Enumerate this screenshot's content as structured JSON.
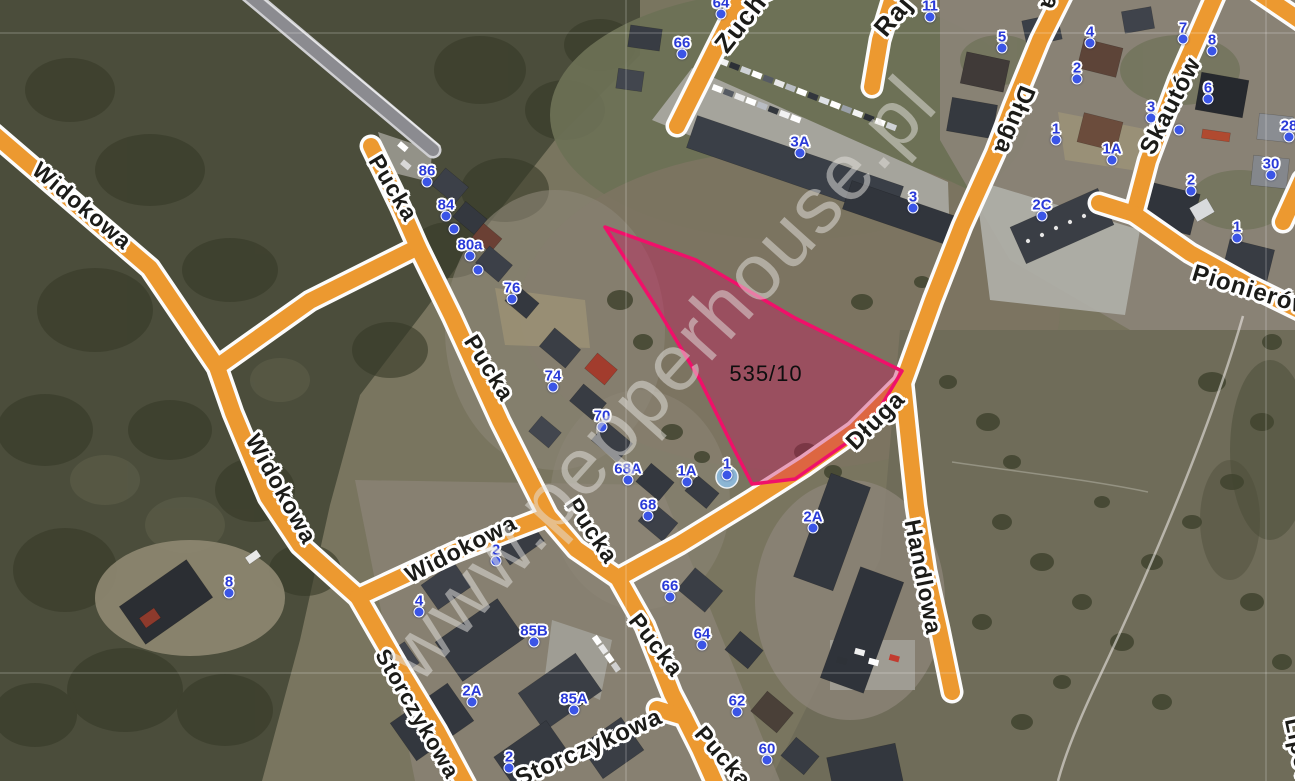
{
  "app": {
    "view": "satellite-map-with-cadastral-overlay"
  },
  "parcel": {
    "label": "535/10",
    "outline_color": "#f0106a",
    "fill_color": "rgba(201,24,93,0.40)"
  },
  "watermark": {
    "text": "www.pepperhouse.pl"
  },
  "colors": {
    "road_fill": "#ec9930",
    "road_casing": "#fcfcfc",
    "highway_gray": "#8b8b90",
    "marker_blue": "#2a3ad8",
    "street_text": "#1b1b18"
  },
  "streets": [
    {
      "label": "Widokowa",
      "x": 82,
      "y": 206,
      "rot": 40,
      "size": 23
    },
    {
      "label": "Widokowa",
      "x": 281,
      "y": 489,
      "rot": 61,
      "size": 23
    },
    {
      "label": "Widokowa",
      "x": 461,
      "y": 549,
      "rot": -27,
      "size": 23
    },
    {
      "label": "Storczykowa",
      "x": 417,
      "y": 714,
      "rot": 60,
      "size": 22
    },
    {
      "label": "Storczykowa",
      "x": 589,
      "y": 748,
      "rot": -24,
      "size": 24
    },
    {
      "label": "Pucka",
      "x": 393,
      "y": 188,
      "rot": 59,
      "size": 23
    },
    {
      "label": "Pucka",
      "x": 489,
      "y": 368,
      "rot": 58,
      "size": 23
    },
    {
      "label": "Pucka",
      "x": 592,
      "y": 531,
      "rot": 56,
      "size": 23
    },
    {
      "label": "Pucka",
      "x": 656,
      "y": 645,
      "rot": 52,
      "size": 23
    },
    {
      "label": "Pucka",
      "x": 723,
      "y": 757,
      "rot": 49,
      "size": 23
    },
    {
      "label": "Długa",
      "x": 1014,
      "y": 120,
      "rot": 112,
      "size": 24
    },
    {
      "label": "Długa",
      "x": 1060,
      "y": -24,
      "rot": 112,
      "size": 24
    },
    {
      "label": "Długa",
      "x": 876,
      "y": 421,
      "rot": -45,
      "size": 24
    },
    {
      "label": "Handlowa",
      "x": 923,
      "y": 577,
      "rot": 79,
      "size": 23
    },
    {
      "label": "Skautów",
      "x": 1171,
      "y": 106,
      "rot": -63,
      "size": 24
    },
    {
      "label": "Pionierów",
      "x": 1252,
      "y": 291,
      "rot": 17,
      "size": 24
    },
    {
      "label": "Zuchów",
      "x": 752,
      "y": 8,
      "rot": -52,
      "size": 26
    },
    {
      "label": "Raj",
      "x": 893,
      "y": 16,
      "rot": -50,
      "size": 26
    },
    {
      "label": "Lipowa",
      "x": 1301,
      "y": 760,
      "rot": 78,
      "size": 23
    }
  ],
  "markers": [
    {
      "label": "86",
      "x": 427,
      "y": 171
    },
    {
      "label": "84",
      "x": 446,
      "y": 205
    },
    {
      "label": "80a",
      "x": 470,
      "y": 245
    },
    {
      "label": "76",
      "x": 512,
      "y": 288
    },
    {
      "label": "74",
      "x": 553,
      "y": 376
    },
    {
      "label": "70",
      "x": 602,
      "y": 416
    },
    {
      "label": "68A",
      "x": 628,
      "y": 469
    },
    {
      "label": "1A",
      "x": 687,
      "y": 471
    },
    {
      "label": "1",
      "x": 727,
      "y": 464
    },
    {
      "label": "68",
      "x": 648,
      "y": 505
    },
    {
      "label": "66",
      "x": 670,
      "y": 586
    },
    {
      "label": "64",
      "x": 702,
      "y": 634
    },
    {
      "label": "62",
      "x": 737,
      "y": 701
    },
    {
      "label": "60",
      "x": 767,
      "y": 749
    },
    {
      "label": "2A",
      "x": 813,
      "y": 517
    },
    {
      "label": "3A",
      "x": 800,
      "y": 142
    },
    {
      "label": "3",
      "x": 913,
      "y": 197
    },
    {
      "label": "66",
      "x": 682,
      "y": 43
    },
    {
      "label": "64",
      "x": 721,
      "y": 3
    },
    {
      "label": "11",
      "x": 930,
      "y": 6
    },
    {
      "label": "5",
      "x": 1002,
      "y": 37
    },
    {
      "label": "4",
      "x": 1090,
      "y": 32
    },
    {
      "label": "2",
      "x": 1077,
      "y": 68
    },
    {
      "label": "7",
      "x": 1183,
      "y": 28
    },
    {
      "label": "8",
      "x": 1212,
      "y": 40
    },
    {
      "label": "6",
      "x": 1208,
      "y": 88
    },
    {
      "label": "3",
      "x": 1151,
      "y": 107
    },
    {
      "label": "1",
      "x": 1056,
      "y": 129
    },
    {
      "label": "1A",
      "x": 1112,
      "y": 149
    },
    {
      "label": "28",
      "x": 1289,
      "y": 126
    },
    {
      "label": "30",
      "x": 1271,
      "y": 164
    },
    {
      "label": "2",
      "x": 1191,
      "y": 180
    },
    {
      "label": "2C",
      "x": 1042,
      "y": 205
    },
    {
      "label": "1",
      "x": 1237,
      "y": 227
    },
    {
      "label": "8",
      "x": 229,
      "y": 582
    },
    {
      "label": "2",
      "x": 496,
      "y": 550
    },
    {
      "label": "4",
      "x": 419,
      "y": 601
    },
    {
      "label": "85B",
      "x": 534,
      "y": 631
    },
    {
      "label": "2A",
      "x": 472,
      "y": 691
    },
    {
      "label": "85A",
      "x": 574,
      "y": 699
    },
    {
      "label": "2",
      "x": 509,
      "y": 757
    }
  ],
  "extra_dots": [
    {
      "x": 454,
      "y": 229
    },
    {
      "x": 478,
      "y": 270
    },
    {
      "x": 1179,
      "y": 130
    }
  ]
}
